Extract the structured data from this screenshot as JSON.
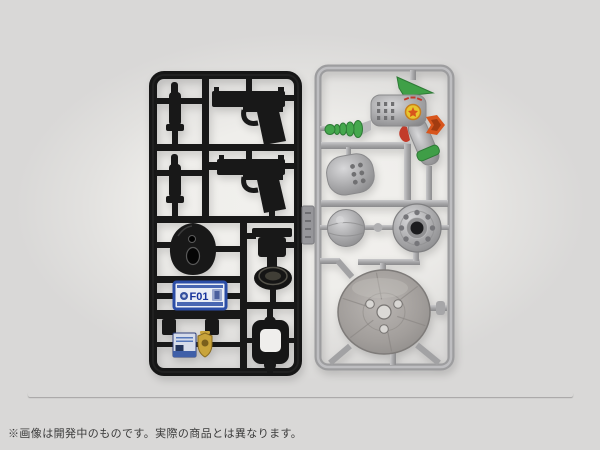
{
  "caption": {
    "text": "※画像は開発中のものです。実際の商品とは異なります。"
  },
  "scene": {
    "background": {
      "outer_color": "#d8d8d7",
      "center_color": "#f2f1ee"
    },
    "black_sprue": {
      "plastic_color": "#181818",
      "license_plate": {
        "text": "F01",
        "frame_color": "#2b4da6",
        "face_color": "#e9edf5"
      },
      "parts": [
        {
          "name": "magazine-part-top"
        },
        {
          "name": "pistol-part-top"
        },
        {
          "name": "magazine-part-bottom"
        },
        {
          "name": "pistol-part-threaded-barrel"
        },
        {
          "name": "teardrop-shell-part"
        },
        {
          "name": "flat-base-part"
        },
        {
          "name": "license-plate-part"
        },
        {
          "name": "bracket-part"
        },
        {
          "name": "id-card-part",
          "color": "#3f5fa8"
        },
        {
          "name": "badge-part",
          "color": "#c9a43b"
        },
        {
          "name": "buckle-frame-part"
        }
      ]
    },
    "silver_sprue": {
      "plastic_color": "#a6a6a8",
      "ray_gun_colors": {
        "fin": "#3fa047",
        "rings": "#45a84d",
        "muzzle_tip": "#d8551c",
        "emblem": "#e8c52e",
        "trigger": "#c23b2a",
        "grip_band": "#3f9e47"
      },
      "parts": [
        {
          "name": "ray-gun-part"
        },
        {
          "name": "pod-part"
        },
        {
          "name": "dome-part"
        },
        {
          "name": "hub-part"
        },
        {
          "name": "saucer-part"
        }
      ]
    },
    "rod": {
      "name": "long-rod-part",
      "color": "#2b282a"
    }
  }
}
